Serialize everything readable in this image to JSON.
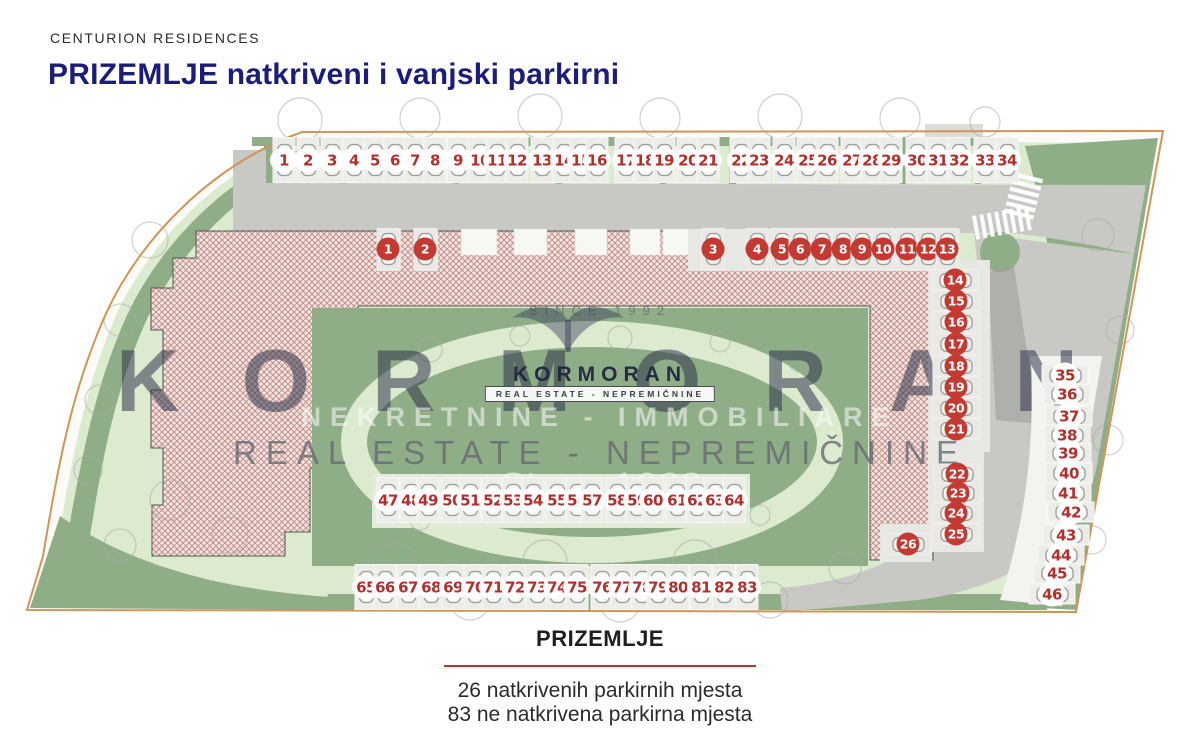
{
  "header": {
    "brand": "CENTURION RESIDENCES",
    "title": "PRIZEMLJE natkriveni i vanjski parkirni"
  },
  "watermark": {
    "since_top": "SINCE 1992",
    "big_text": "KORMORAN",
    "logo_text": "KORMORAN",
    "logo_box": "REAL ESTATE - NEPREMIČNINE",
    "line_nekretnine": "NEKRETNINE - IMMOBILIARE",
    "line_realestate": "REAL ESTATE - NEPREMIČNINE",
    "script_text": "Since 1992"
  },
  "footer": {
    "title": "PRIZEMLJE",
    "line1": "26 natkrivenih parkirnih mjesta",
    "line2": "83 ne natkrivena parkirna mjesta"
  },
  "legend": {
    "covered_count": 26,
    "outdoor_count": 83
  },
  "colors": {
    "title_navy": "#1c1c7a",
    "badge_covered_red": "#c23a31",
    "number_red": "#b0302c",
    "boundary_tan": "#d09558",
    "road_gray": "#c8c8c5",
    "green_dark": "#8fae88",
    "green_light": "#dcead0",
    "building_hatch": "#c59089",
    "caption_rule_red": "#b6362f"
  },
  "plan": {
    "parking_groups": [
      {
        "id": "street-row",
        "kind": "outdoor",
        "orient": "v",
        "y": 160,
        "spots": [
          [
            1,
            284
          ],
          [
            2,
            308
          ],
          [
            3,
            332
          ],
          [
            4,
            354
          ],
          [
            5,
            375
          ],
          [
            6,
            395
          ],
          [
            7,
            415
          ],
          [
            8,
            435
          ],
          [
            9,
            458
          ],
          [
            10,
            480
          ],
          [
            11,
            497
          ],
          [
            12,
            517
          ],
          [
            13,
            542
          ],
          [
            14,
            564
          ],
          [
            15,
            581
          ],
          [
            16,
            597
          ],
          [
            17,
            626
          ],
          [
            18,
            645
          ],
          [
            19,
            664
          ],
          [
            20,
            688
          ],
          [
            21,
            708
          ],
          [
            22,
            741
          ],
          [
            23,
            759
          ],
          [
            24,
            784
          ],
          [
            25,
            808
          ],
          [
            26,
            827
          ],
          [
            27,
            852
          ],
          [
            28,
            872
          ],
          [
            29,
            891
          ],
          [
            30,
            917
          ],
          [
            31,
            938
          ],
          [
            32,
            959
          ],
          [
            33,
            985
          ],
          [
            34,
            1007
          ]
        ]
      },
      {
        "id": "covered-north",
        "kind": "covered",
        "orient": "v",
        "y": 249,
        "spots": [
          [
            1,
            388
          ],
          [
            2,
            425
          ],
          [
            3,
            713
          ],
          [
            4,
            757
          ],
          [
            5,
            782
          ],
          [
            6,
            800
          ],
          [
            7,
            822
          ],
          [
            8,
            843
          ],
          [
            9,
            862
          ],
          [
            10,
            883
          ],
          [
            11,
            907
          ],
          [
            12,
            928
          ],
          [
            13,
            947
          ]
        ]
      },
      {
        "id": "covered-east",
        "kind": "covered",
        "orient": "h",
        "spots": [
          [
            14,
            955,
            280
          ],
          [
            15,
            956,
            301
          ],
          [
            16,
            956,
            322
          ],
          [
            17,
            956,
            344
          ],
          [
            18,
            956,
            366
          ],
          [
            19,
            956,
            387
          ],
          [
            20,
            956,
            408
          ],
          [
            21,
            956,
            429
          ],
          [
            22,
            957,
            474
          ],
          [
            23,
            958,
            493
          ],
          [
            24,
            956,
            513
          ],
          [
            25,
            956,
            534
          ],
          [
            26,
            908,
            544
          ]
        ]
      },
      {
        "id": "east-lot",
        "kind": "outdoor",
        "orient": "h",
        "spots": [
          [
            35,
            1065,
            375
          ],
          [
            36,
            1067,
            394
          ],
          [
            37,
            1069,
            416
          ],
          [
            38,
            1067,
            435
          ],
          [
            39,
            1068,
            453
          ],
          [
            40,
            1069,
            473
          ],
          [
            41,
            1068,
            493
          ],
          [
            42,
            1071,
            512
          ],
          [
            43,
            1066,
            535
          ],
          [
            44,
            1061,
            555
          ],
          [
            45,
            1057,
            573
          ],
          [
            46,
            1052,
            594
          ]
        ]
      },
      {
        "id": "courtyard-row",
        "kind": "outdoor",
        "orient": "v",
        "y": 500,
        "spots": [
          [
            47,
            388
          ],
          [
            48,
            411
          ],
          [
            49,
            428
          ],
          [
            50,
            452
          ],
          [
            51,
            470
          ],
          [
            52,
            493
          ],
          [
            53,
            513
          ],
          [
            54,
            533
          ],
          [
            55,
            557
          ],
          [
            56,
            577
          ],
          [
            57,
            592
          ],
          [
            58,
            617
          ],
          [
            59,
            637
          ],
          [
            60,
            653
          ],
          [
            61,
            677
          ],
          [
            62,
            697
          ],
          [
            63,
            715
          ],
          [
            64,
            734
          ]
        ]
      },
      {
        "id": "south-row",
        "kind": "outdoor",
        "orient": "v",
        "y": 587,
        "spots": [
          [
            65,
            366
          ],
          [
            66,
            385
          ],
          [
            67,
            408
          ],
          [
            68,
            431
          ],
          [
            69,
            453
          ],
          [
            70,
            475
          ],
          [
            71,
            493
          ],
          [
            72,
            515
          ],
          [
            73,
            537
          ],
          [
            74,
            557
          ],
          [
            75,
            577
          ],
          [
            76,
            602
          ],
          [
            77,
            622
          ],
          [
            78,
            642
          ],
          [
            79,
            658
          ],
          [
            80,
            678
          ],
          [
            81,
            701
          ],
          [
            82,
            724
          ],
          [
            83,
            747
          ]
        ]
      }
    ]
  }
}
